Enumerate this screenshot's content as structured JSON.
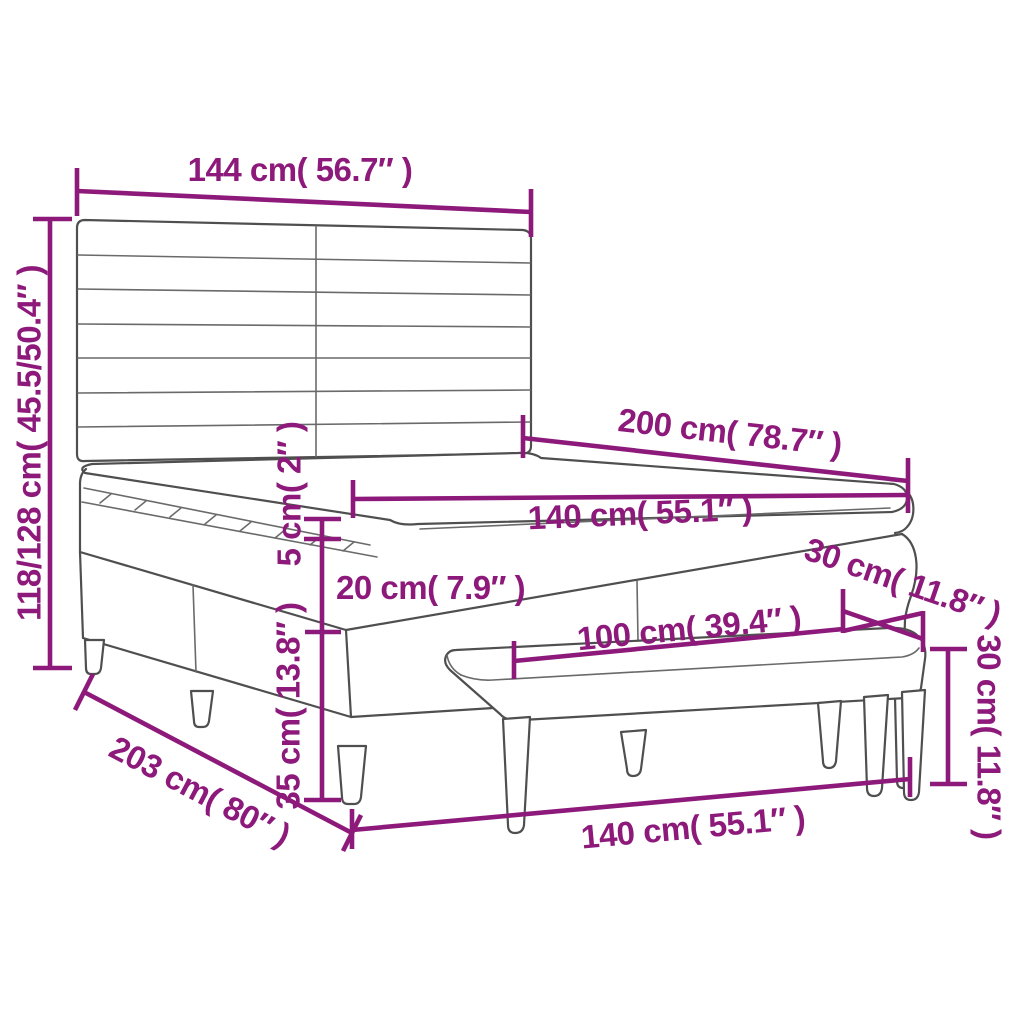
{
  "diagram": {
    "type": "furniture-dimension-drawing",
    "subject": "box spring bed with striped headboard, mattress topper and bench",
    "colors": {
      "accent": "#8D1A7B",
      "line": "#4F4F4F",
      "line_soft": "#6A6A6A",
      "background": "#FFFFFF"
    },
    "dimensions": [
      {
        "id": "headboard-width",
        "label": "144 cm( 56.7″ )"
      },
      {
        "id": "headboard-height",
        "label": "118/128 cm( 45.5/50.4″ )"
      },
      {
        "id": "bed-length",
        "label": "200 cm( 78.7″ )"
      },
      {
        "id": "mattress-width",
        "label": "140 cm( 55.1″ )"
      },
      {
        "id": "topper-height",
        "label": "5 cm( 2″ )"
      },
      {
        "id": "mattress-height",
        "label": "20 cm( 7.9″ )"
      },
      {
        "id": "base-height",
        "label": "35 cm( 13.8″ )"
      },
      {
        "id": "bench-depth",
        "label": "30 cm( 11.8″ )"
      },
      {
        "id": "bench-height",
        "label": "30 cm( 11.8″ )"
      },
      {
        "id": "bench-width",
        "label": "100 cm( 39.4″ )"
      },
      {
        "id": "base-length",
        "label": "203 cm( 80″ )"
      },
      {
        "id": "base-width",
        "label": "140 cm( 55.1″ )"
      }
    ]
  }
}
